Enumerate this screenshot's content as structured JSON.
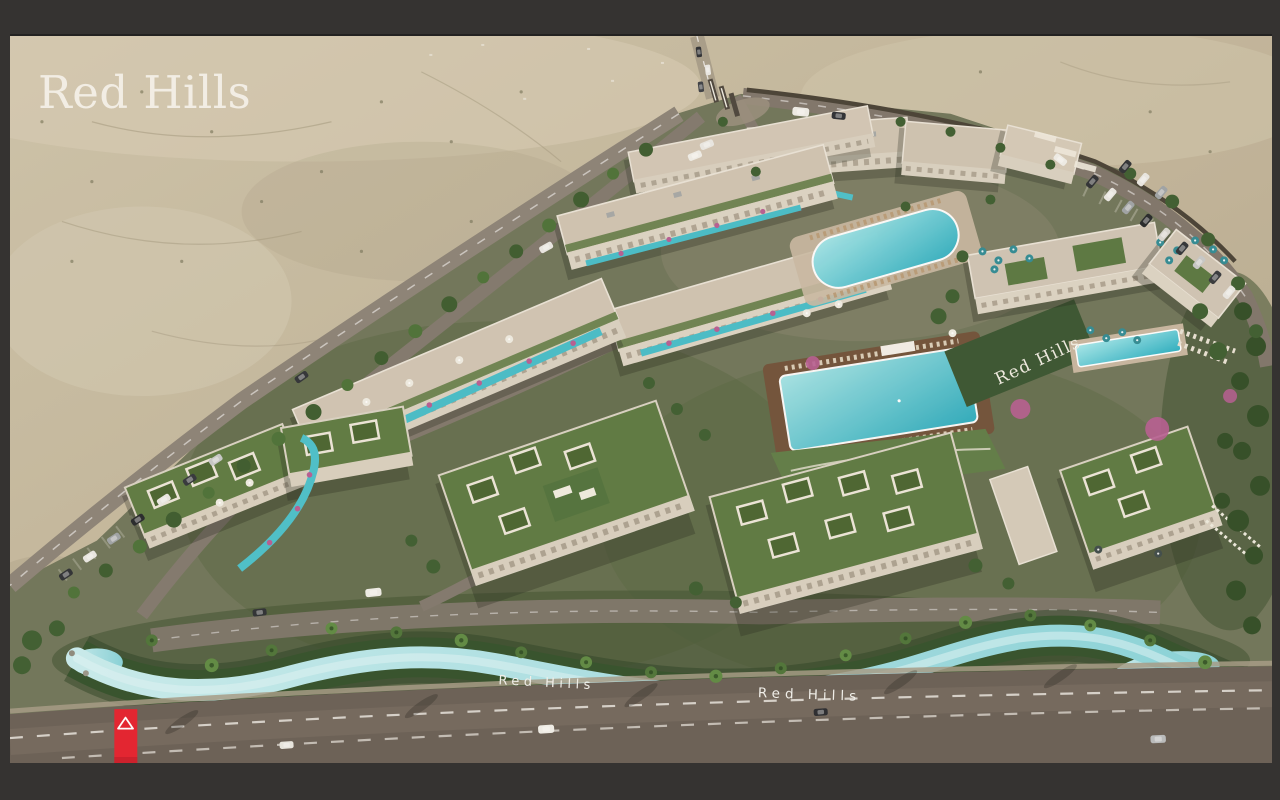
{
  "branding": {
    "logo_text": "Red Hills",
    "hillside_sign": "Red Hills",
    "river_sign_left": "Red Hills",
    "river_sign_right": "Red Hills"
  },
  "side_tab": {
    "icon": "triangle-up-outline-icon",
    "background": "#e41f2d"
  },
  "palette": {
    "frame": "#353331",
    "desert": "#c3b79d",
    "asphalt": "#6b6057",
    "building_wall": "#dcd4c4",
    "green_roof": "#5b7941",
    "landscape_green": "#3c5a2f",
    "pool_water": "#3ab5c6",
    "lazy_river": "#a9dde1",
    "bougainvillea": "#b65c92",
    "brand_red": "#e41f2d",
    "logo_color": "#f4f1e9"
  }
}
